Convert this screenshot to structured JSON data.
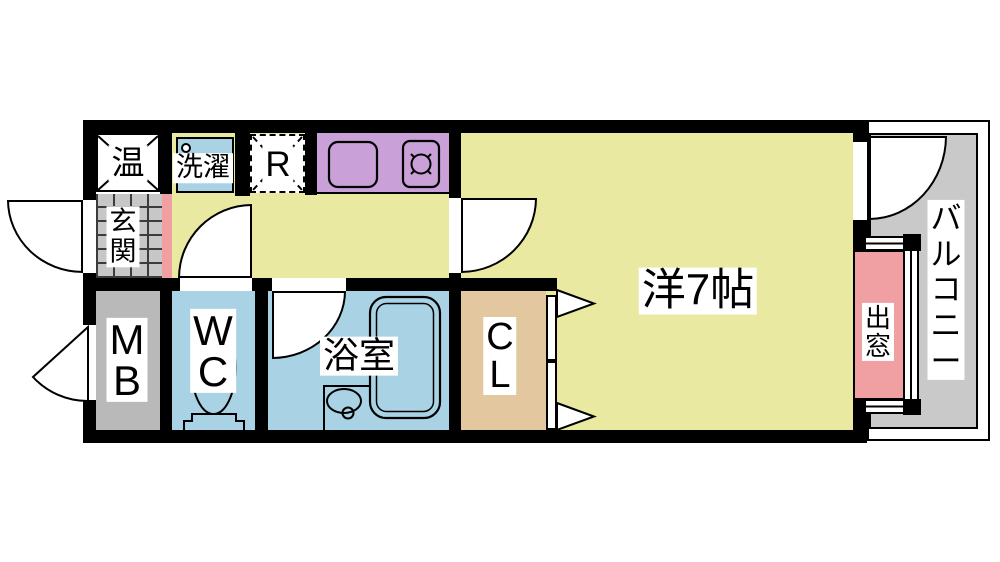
{
  "floorplan": {
    "type": "Japanese apartment floor plan (1K)",
    "labels": {
      "water_heater": "温",
      "laundry": "洗濯",
      "refrigerator": "R",
      "entrance": "玄\n関",
      "meter_box": "M\nB",
      "toilet": "W\nC",
      "bathroom": "浴室",
      "closet": "C\nL",
      "western_room": "洋7帖",
      "bay_window": "出\n窓",
      "balcony": "バ\nル\nコ\nニ\nー"
    },
    "colors": {
      "floor_yellow": "#e9e9a1",
      "wet_area_blue": "#a9d3e5",
      "kitchen_purple": "#c9a1d8",
      "accent_pink": "#f0a0a2",
      "entrance_tile_gray": "#c7c7c7",
      "meter_box_gray": "#b9b9b9",
      "balcony_gray": "#c9c9c9",
      "closet_tan": "#e3c79f",
      "wall_black": "#000000"
    }
  }
}
